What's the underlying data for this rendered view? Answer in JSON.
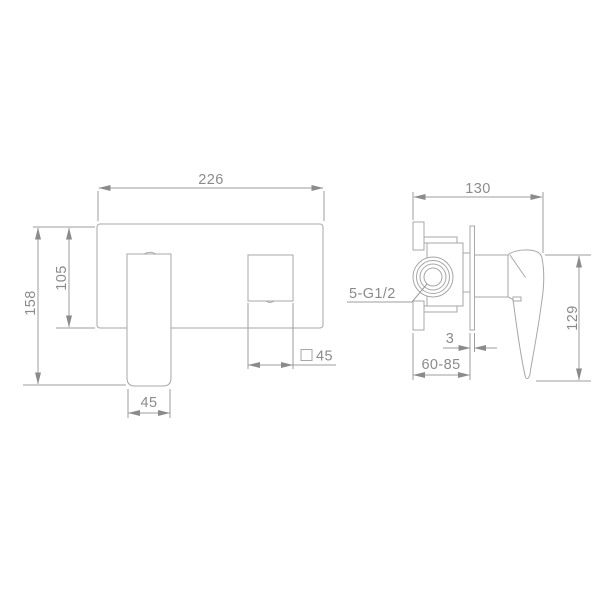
{
  "meta": {
    "background_color": "#ffffff",
    "line_color": "#a7a7a7",
    "text_color": "#8b8b8b"
  },
  "front_view": {
    "dim_plate_width": "226",
    "dim_total_height": "158",
    "dim_plate_height": "105",
    "dim_handle_width": "45",
    "dim_spout_section": "45"
  },
  "side_view": {
    "dim_depth": "130",
    "dim_height": "129",
    "dim_flange_thickness": "3",
    "dim_install_depth": "60-85",
    "label_connection": "5-G1/2"
  }
}
